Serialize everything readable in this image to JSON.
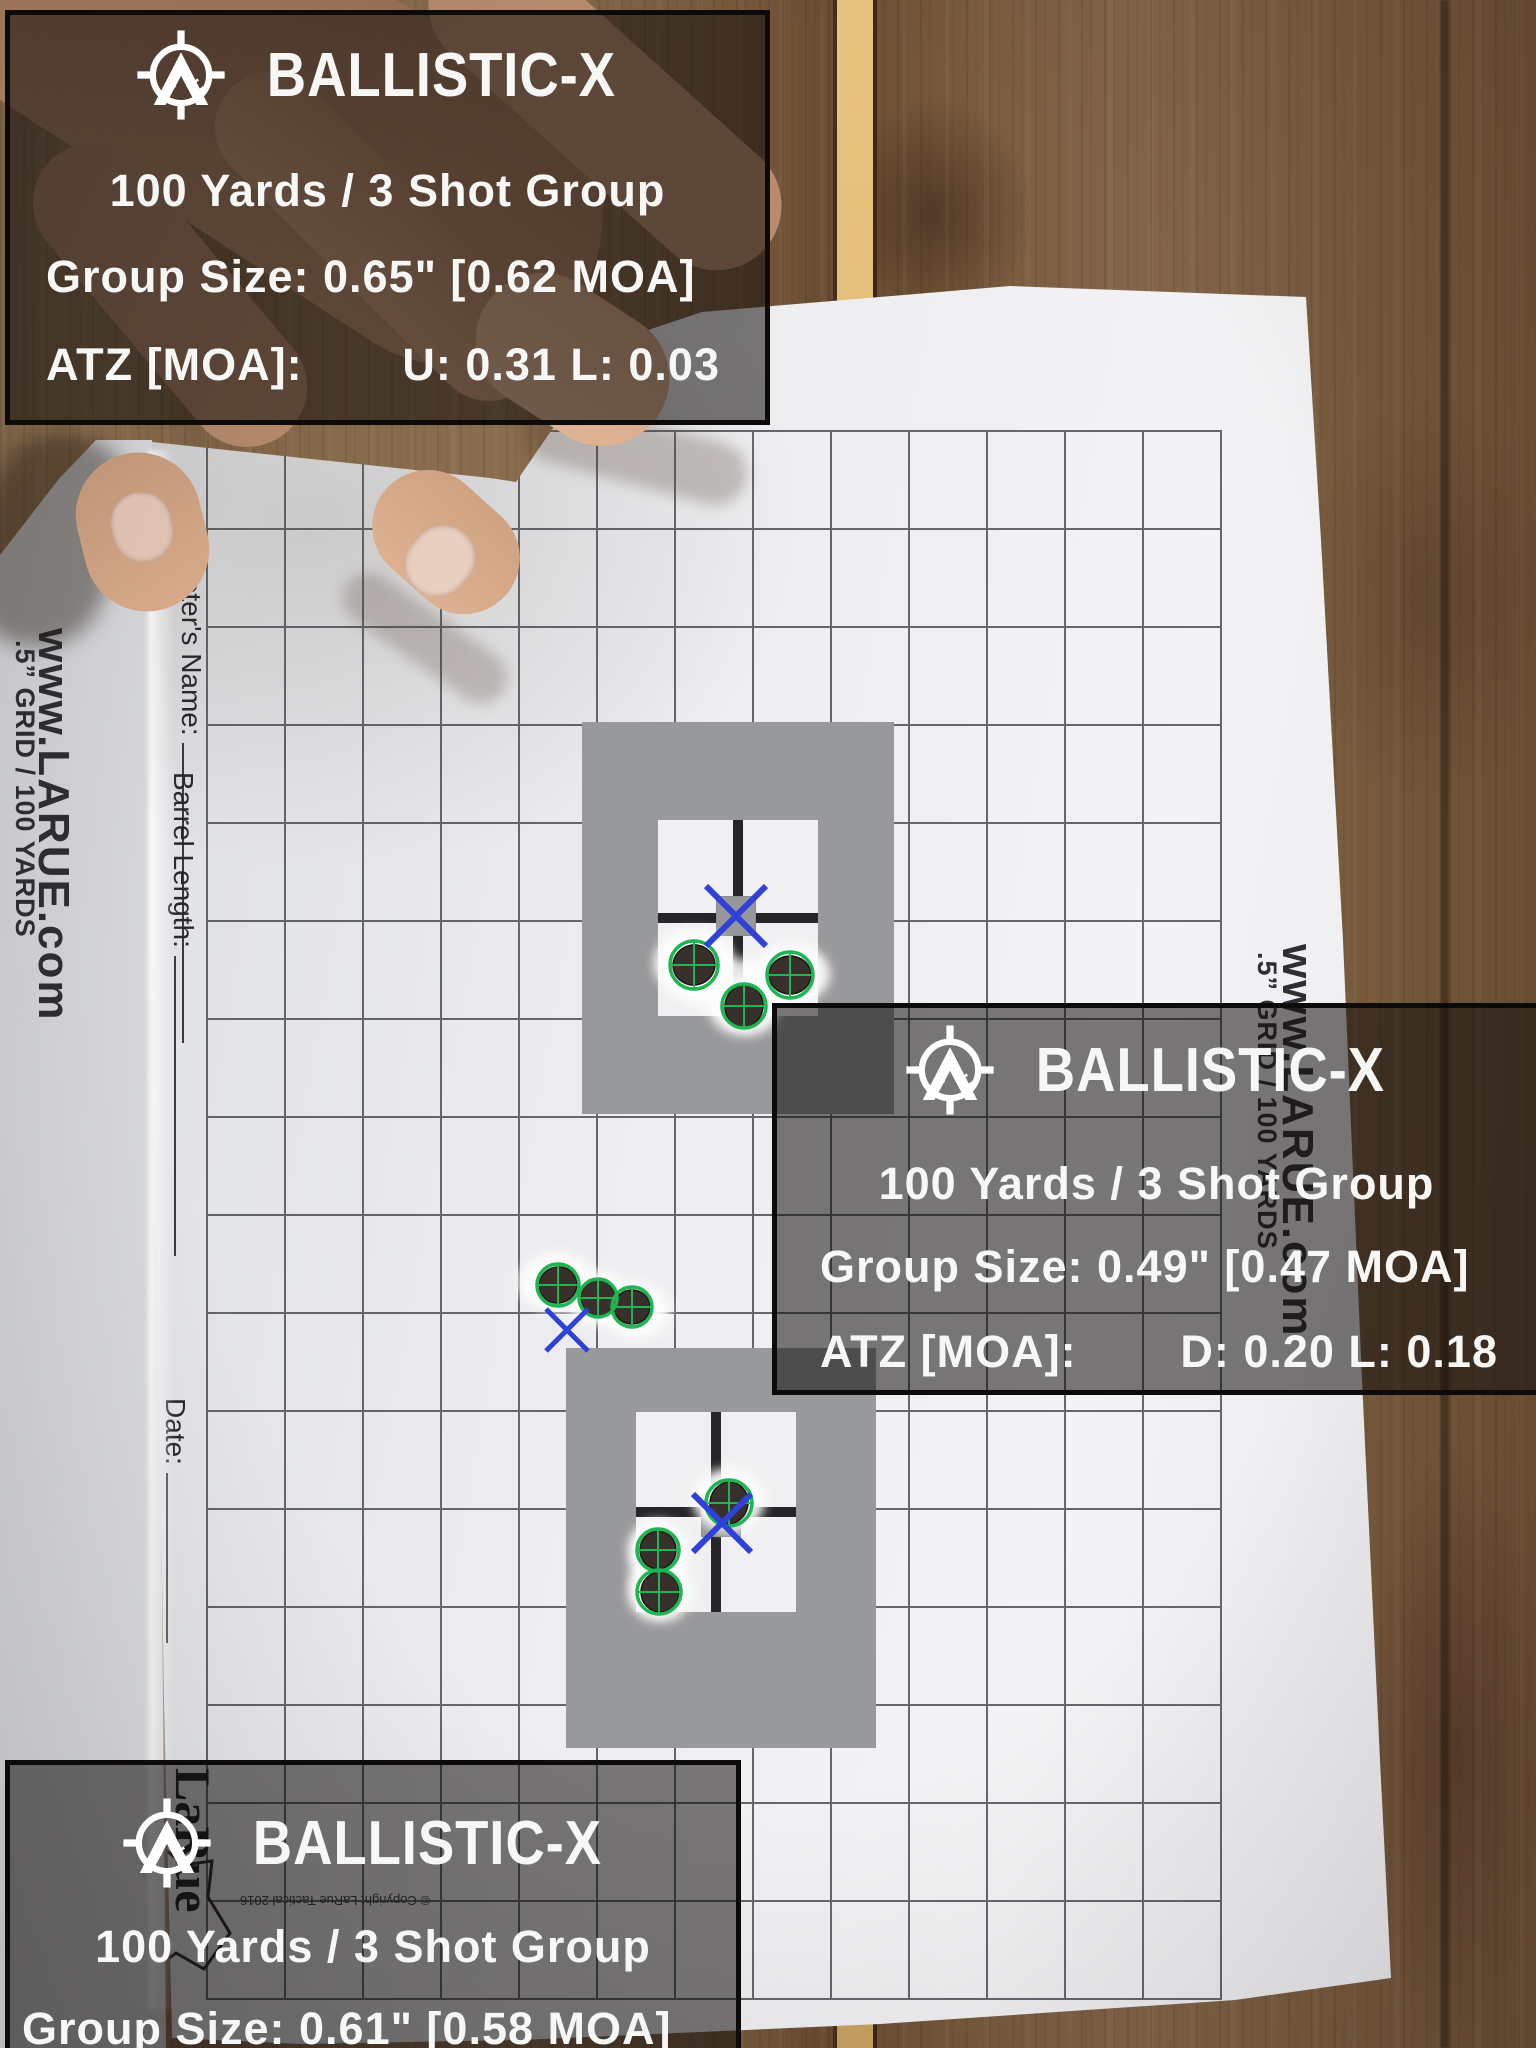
{
  "app": {
    "brand": "BALLISTIC-X"
  },
  "overlays": [
    {
      "header": "100 Yards / 3 Shot Group",
      "group_size": "Group Size: 0.65\" [0.62 MOA]",
      "atz_label": "ATZ [MOA]:",
      "atz_values": "U: 0.31 L: 0.03"
    },
    {
      "header": "100 Yards / 3 Shot Group",
      "group_size": "Group Size: 0.49\" [0.47 MOA]",
      "atz_label": "ATZ [MOA]:",
      "atz_values": "D: 0.20 L: 0.18"
    },
    {
      "header": "100 Yards / 3 Shot Group",
      "group_size": "Group Size: 0.61\" [0.58 MOA]"
    }
  ],
  "shot_groups": [
    {
      "distance_yards": 100,
      "shots": 3,
      "size_inches": 0.65,
      "size_moa": 0.62,
      "atz_moa": {
        "U": 0.31,
        "L": 0.03
      }
    },
    {
      "distance_yards": 100,
      "shots": 3,
      "size_inches": 0.49,
      "size_moa": 0.47,
      "atz_moa": {
        "D": 0.2,
        "L": 0.18
      }
    },
    {
      "distance_yards": 100,
      "shots": 3,
      "size_inches": 0.61,
      "size_moa": 0.58
    }
  ],
  "target": {
    "margin_url": "www.LARUE.com",
    "margin_grid": ".5” GRID / 100 YARDS",
    "labels": {
      "ammo": "Amm",
      "shooter": "Shooter's Name:",
      "barrel": "Barrel Length:",
      "date": "Date:"
    },
    "logo_line1": "LaRue",
    "logo_line2": "Tactical",
    "address": [
      "50 County Road 177",
      "r, Texas USA 78",
      "-1585 www.LaRue.com"
    ],
    "copyright": "© Copyright LaRue Tactical 2016"
  },
  "colors": {
    "hit_ring": "#1fb552",
    "aim_x": "#2e41d8",
    "panel_bg": "rgba(18,15,12,0.55)",
    "gray_block": "#98999b"
  }
}
